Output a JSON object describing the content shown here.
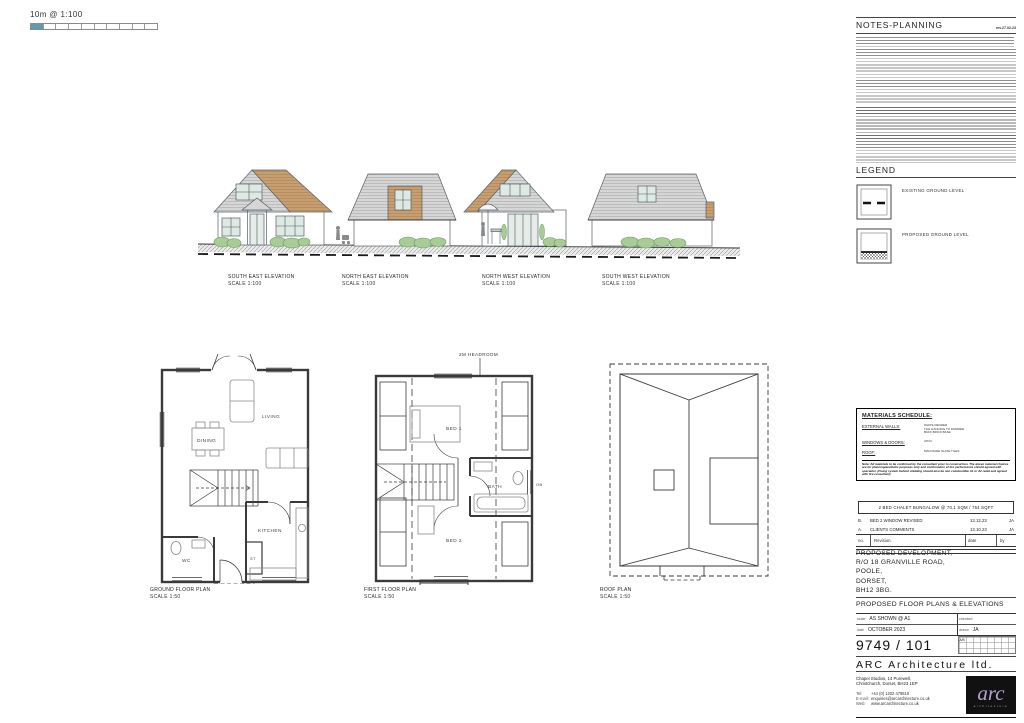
{
  "scale_bar": {
    "label": "10m @ 1:100"
  },
  "notes": {
    "title": "NOTES-PLANNING",
    "revision": "rev.27.02.23"
  },
  "legend": {
    "title": "LEGEND",
    "existing_label": "EXISTING GROUND LEVEL",
    "proposed_label": "PROPOSED GROUND LEVEL"
  },
  "elevations": {
    "items": [
      {
        "name": "SOUTH EAST ELEVATION",
        "scale": "SCALE 1:100"
      },
      {
        "name": "NORTH EAST ELEVATION",
        "scale": "SCALE 1:100"
      },
      {
        "name": "NORTH WEST ELEVATION",
        "scale": "SCALE 1:100"
      },
      {
        "name": "SOUTH WEST ELEVATION",
        "scale": "SCALE 1:100"
      }
    ]
  },
  "plans": {
    "ground": {
      "title": "GROUND FLOOR PLAN",
      "scale": "SCALE 1:50",
      "rooms": {
        "living": "LIVING",
        "dining": "DINING",
        "kitchen": "KITCHEN",
        "wc": "WC",
        "store": "ST"
      }
    },
    "first": {
      "title": "FIRST FLOOR PLAN",
      "scale": "SCALE 1:50",
      "headroom_note": "2M HEADROOM",
      "rooms": {
        "bed1": "BED 1",
        "bed2": "BED 2",
        "bath": "BATH"
      },
      "window_note": "OB"
    },
    "roof": {
      "title": "ROOF PLAN",
      "scale": "SCALE 1:50"
    }
  },
  "materials": {
    "title": "MATERIALS SCHEDULE:",
    "rows": [
      {
        "label": "EXTERNAL WALLS:",
        "value": "WHITE RENDER\nTILE HANGING TO DORMER\nBUFF BRICK BASE"
      },
      {
        "label": "WINDOWS & DOORS:",
        "value": "UPVC"
      },
      {
        "label": "ROOF:",
        "value": "MAN MADE SLATE TILES"
      }
    ],
    "note": "Note: All materials to be confirmed by the consultant prior to construction. The above material choices are for planning/aesthetic purposes only and confirmation of fire performance should agreed with specialist. (Fixing system behind cladding should also be non combustible A1 or A2 rated and agreed with fire consultant)"
  },
  "revisions": {
    "job_summary": "2 BED CHALET BUNGALOW @ 70.1 SQM / 754 SQFT",
    "rows": [
      {
        "no": "B.",
        "description": "BED 2 WINDOW REVISED",
        "date": "13.12.23",
        "by": "JA"
      },
      {
        "no": "A.",
        "description": "CLIENTS COMMENTS",
        "date": "13.10.23",
        "by": "JA"
      }
    ],
    "header": {
      "no": "no.",
      "revision": "Revision.",
      "date": "date",
      "by": "by"
    }
  },
  "titleblock": {
    "project": "PROPOSED DEVELOPMENT,\nR/O 18 GRANVILLE ROAD,\nPOOLE,\nDORSET,\nBH12 3BG.",
    "drawing_title": "PROPOSED FLOOR PLANS & ELEVATIONS",
    "scale_label": "scale",
    "scale_value": "AS SHOWN @ A1",
    "checked_label": "checked",
    "date_label": "date",
    "date_value": "OCTOBER 2023",
    "drawn_label": "drawn",
    "drawn_value": "JA",
    "drawing_number": "9749 / 101",
    "grid_ref": "A/B",
    "company": "ARC Architecture ltd.",
    "address": "Chapel Studios, 14 Purewell,\nChristchurch, Dorset, BH23 1EP",
    "tel_label": "Tel:",
    "tel": "+44 (0) 1202 479819",
    "email_label": "E-mail:",
    "email": "enquiries@arcarchitecture.co.uk",
    "web_label": "Web:",
    "web": "www.arcarchitecture.co.uk",
    "logo_text": "arc",
    "logo_sub": "architecture"
  },
  "colors": {
    "accent_teal": "#5b9cb3",
    "roof_grey": "#d6d6d6",
    "cladding_tan": "#c79e6f",
    "bush_green": "#a8cc96",
    "logo_purple": "#b9a0d0"
  }
}
